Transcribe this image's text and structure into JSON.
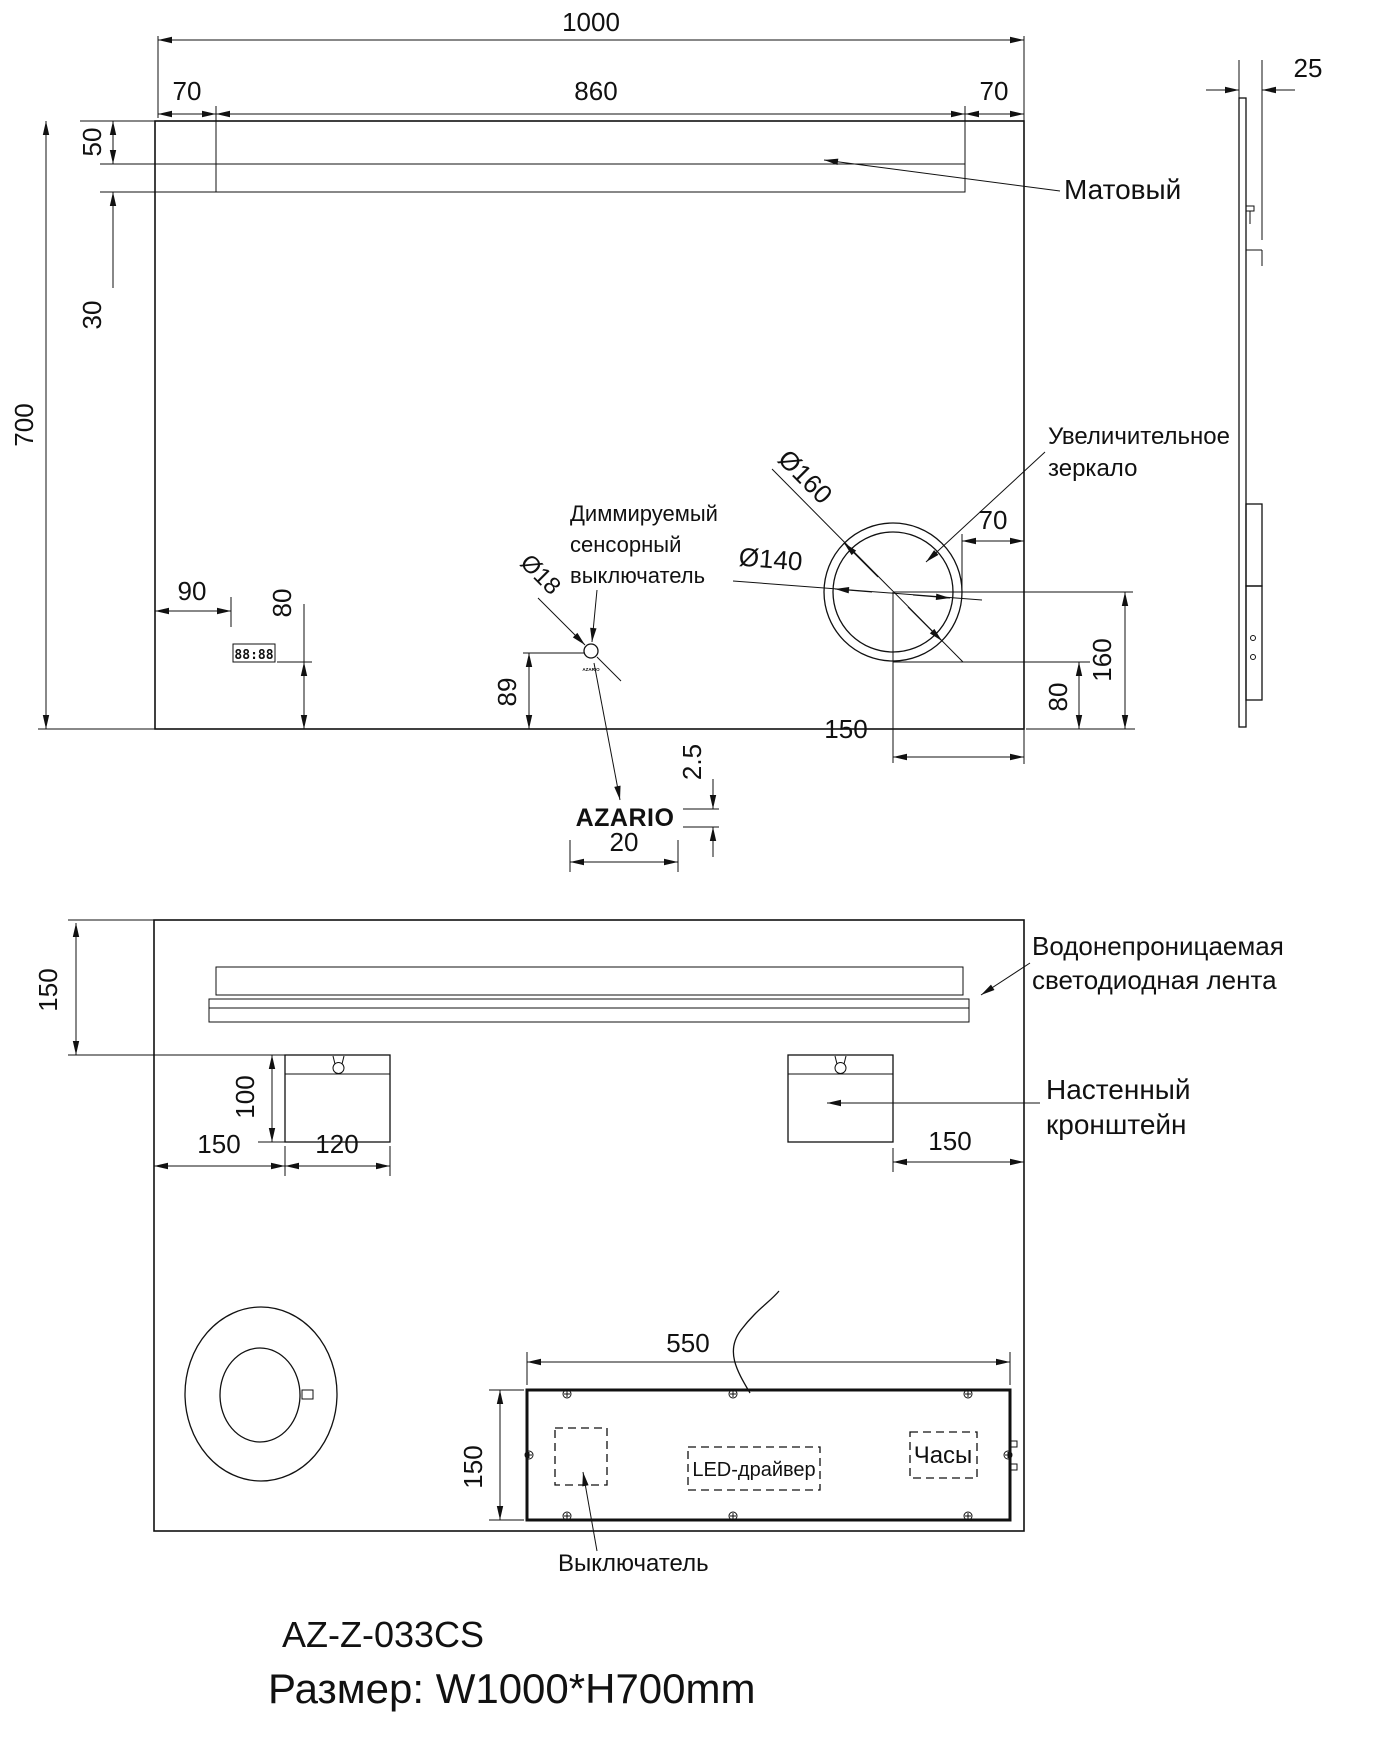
{
  "title_block": {
    "model": "AZ-Z-033CS",
    "size": "Размер: W1000*H700mm"
  },
  "front_view": {
    "dim_width": "1000",
    "dim_led_left": "70",
    "dim_led_width": "860",
    "dim_led_right": "70",
    "dim_led_top": "50",
    "dim_led_height": "30",
    "dim_height": "700",
    "dim_clock_left": "90",
    "dim_clock_bottom": "80",
    "dim_switch_dia": "Ø18",
    "dim_switch_bottom": "89",
    "dim_logo_height": "2.5",
    "dim_logo_width": "20",
    "dim_mag_outer": "Ø160",
    "dim_mag_inner": "Ø140",
    "dim_mag_right": "70",
    "dim_mag_center_bottom": "160",
    "dim_mag_edge_bottom": "80",
    "dim_mag_center_right": "150",
    "label_matte": "Матовый",
    "label_mag_1": "Увеличительное",
    "label_mag_2": "зеркало",
    "label_switch_1": "Диммируемый",
    "label_switch_2": "сенсорный",
    "label_switch_3": "выключатель",
    "logo": "AZARIO",
    "switch_logo": "AZARIO",
    "clock_display": "88:88"
  },
  "side_view": {
    "dim_depth": "25"
  },
  "back_view": {
    "dim_strip_top": "150",
    "dim_bracket_height": "100",
    "dim_bracket_left": "150",
    "dim_bracket_width": "120",
    "dim_bracket_right": "150",
    "dim_box_width": "550",
    "dim_box_height": "150",
    "label_led_1": "Водонепроницаемая",
    "label_led_2": "светодиодная лента",
    "label_bracket_1": "Настенный",
    "label_bracket_2": "кронштейн",
    "label_driver": "LED-драйвер",
    "label_clock": "Часы",
    "label_switch": "Выключатель"
  }
}
